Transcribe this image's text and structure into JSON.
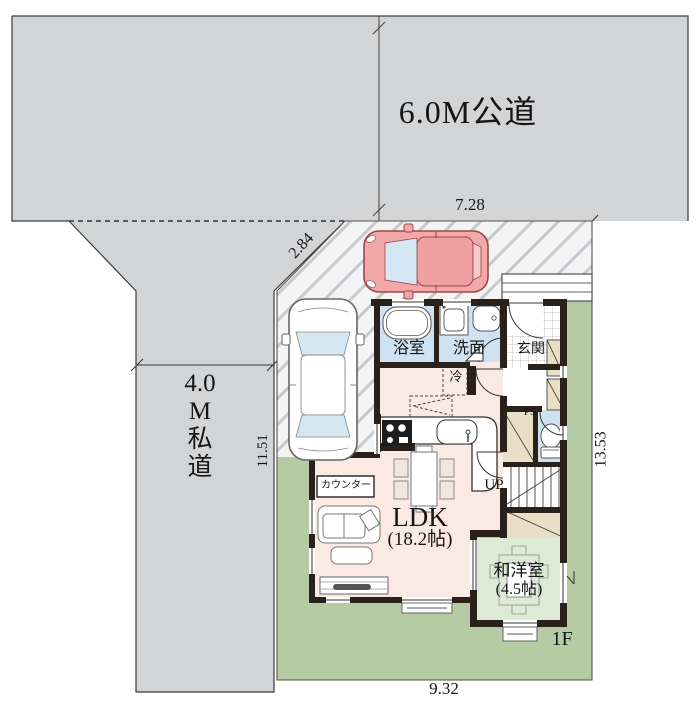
{
  "roads": {
    "main": {
      "label": "6.0M公道"
    },
    "side": {
      "label": "4.0M私道",
      "lines": [
        "4.0",
        "M",
        "私",
        "道"
      ]
    }
  },
  "dimensions": {
    "frontage": "7.28",
    "corner": "2.84",
    "side_depth": "11.51",
    "depth": "13.53",
    "width": "9.32"
  },
  "floor_label": "1F",
  "rooms": {
    "ldk": {
      "name": "LDK",
      "size": "(18.2帖)"
    },
    "jwroom": {
      "name": "和洋室",
      "size": "(4.5帖)"
    },
    "bath": {
      "name": "浴室"
    },
    "wash": {
      "name": "洗面"
    },
    "entrance": {
      "name": "玄関"
    },
    "stairs_label": "UP",
    "ps_label": "PS",
    "fridge_label": "冷",
    "counter_label": "カウンター"
  },
  "palette": {
    "road": "#d3d4d6",
    "drive": "#f4f4f5",
    "lawn": "#b5cba3",
    "tatami": "#dcead6",
    "ldk": "#faeae3",
    "wet": "#cfe2f1",
    "closet": "#e8dfc6",
    "wall": "#2b211b",
    "car-pink": "#f2a7a8",
    "glass": "#d4e7f2"
  }
}
